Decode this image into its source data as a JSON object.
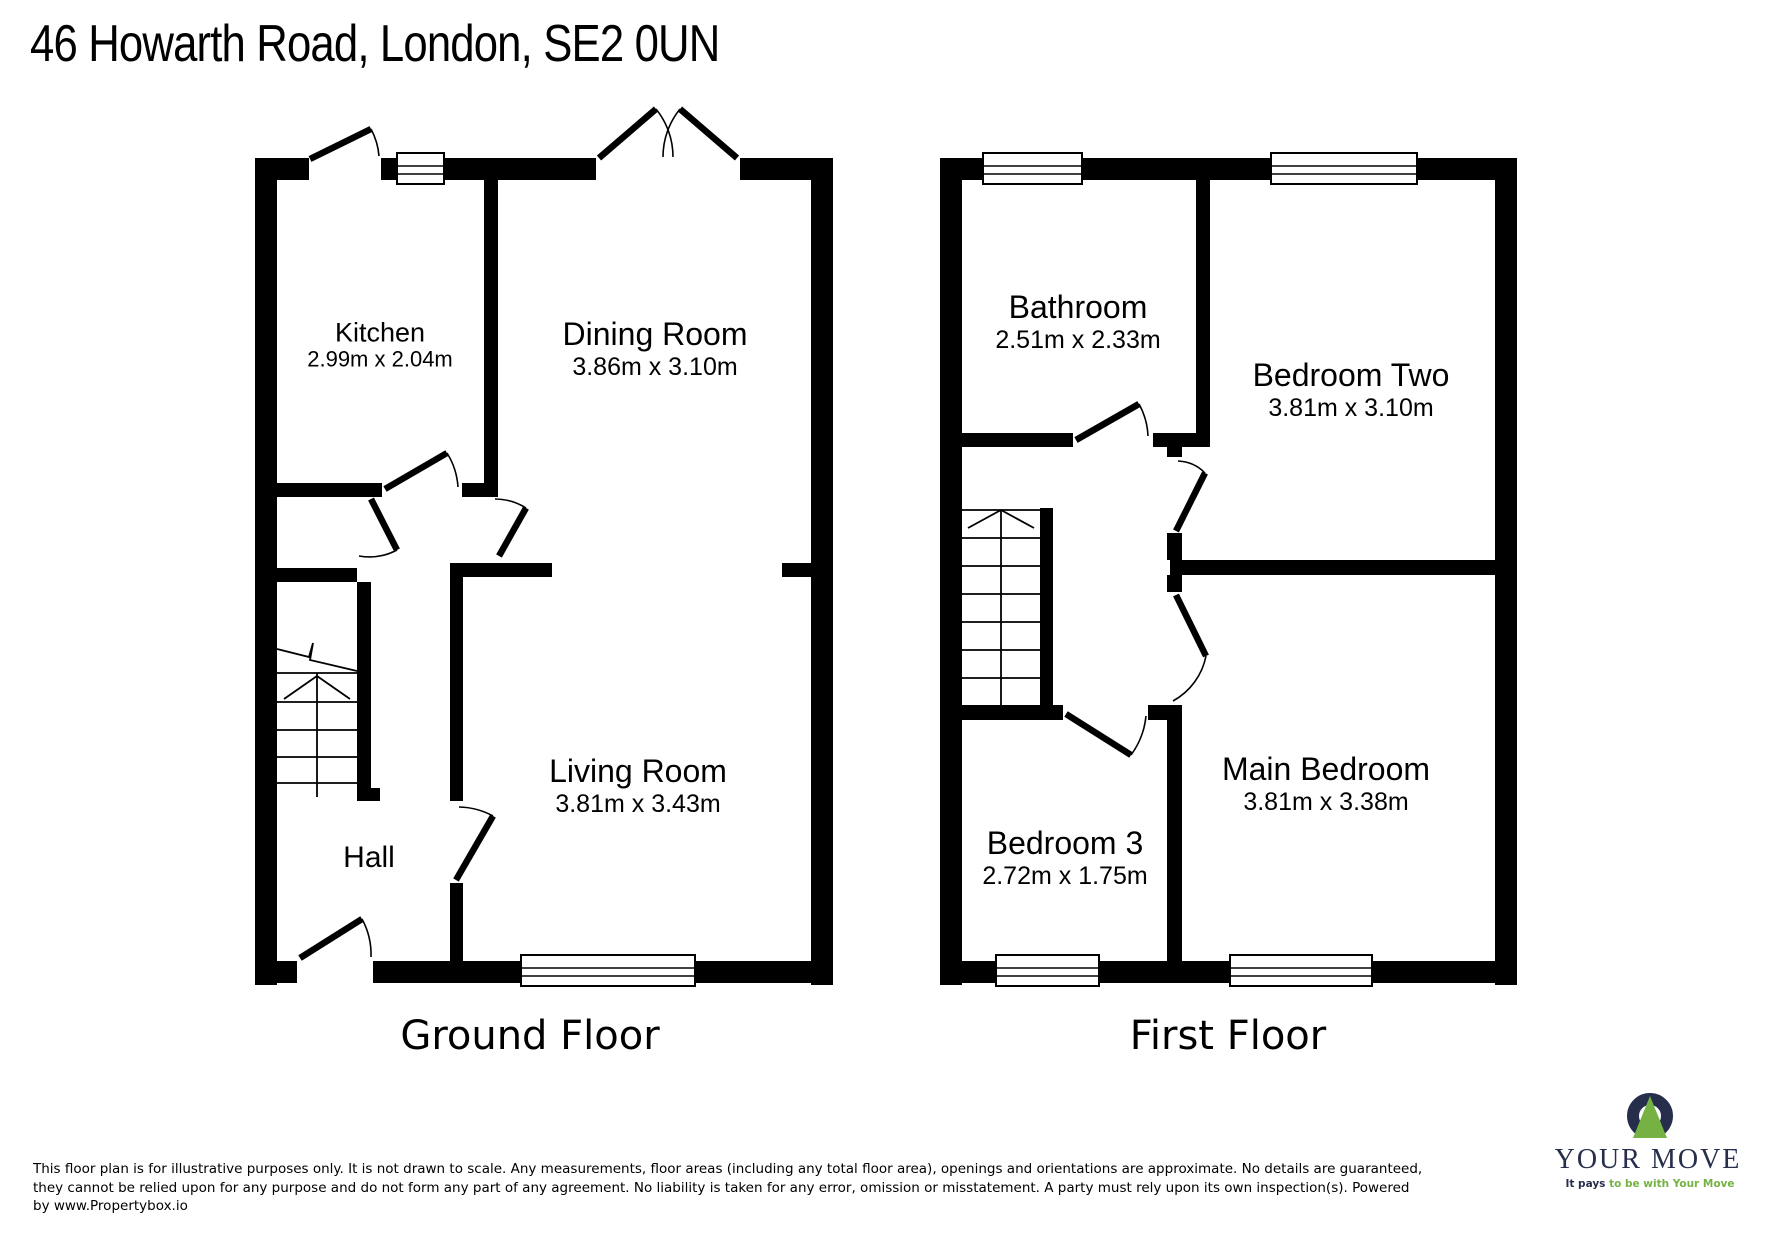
{
  "title": "46 Howarth Road, London, SE2 0UN",
  "ground_floor": {
    "label": "Ground Floor",
    "rooms": {
      "kitchen": {
        "name": "Kitchen",
        "dims": "2.99m x 2.04m"
      },
      "dining": {
        "name": "Dining Room",
        "dims": "3.86m x 3.10m"
      },
      "living": {
        "name": "Living Room",
        "dims": "3.81m x 3.43m"
      },
      "hall": {
        "name": "Hall"
      }
    }
  },
  "first_floor": {
    "label": "First Floor",
    "rooms": {
      "bathroom": {
        "name": "Bathroom",
        "dims": "2.51m x 2.33m"
      },
      "bedroom_two": {
        "name": "Bedroom Two",
        "dims": "3.81m x 3.10m"
      },
      "bedroom_three": {
        "name": "Bedroom 3",
        "dims": "2.72m x 1.75m"
      },
      "main_bedroom": {
        "name": "Main Bedroom",
        "dims": "3.81m x 3.38m"
      }
    }
  },
  "disclaimer": {
    "line1": "This floor plan is for illustrative purposes only. It is not drawn to scale. Any measurements, floor areas (including any total floor area), openings and orientations are approximate. No details are guaranteed,",
    "line2": "they cannot be relied upon for any purpose and do not form any part of any agreement. No liability is taken for any error, omission or misstatement. A party must rely upon its own inspection(s). Powered",
    "line3": "by www.Propertybox.io"
  },
  "logo": {
    "brand": "YOUR MOVE",
    "tagline_bold": "It pays",
    "tagline_rest": " to be with Your Move",
    "navy": "#272e4b",
    "green": "#76b144"
  }
}
